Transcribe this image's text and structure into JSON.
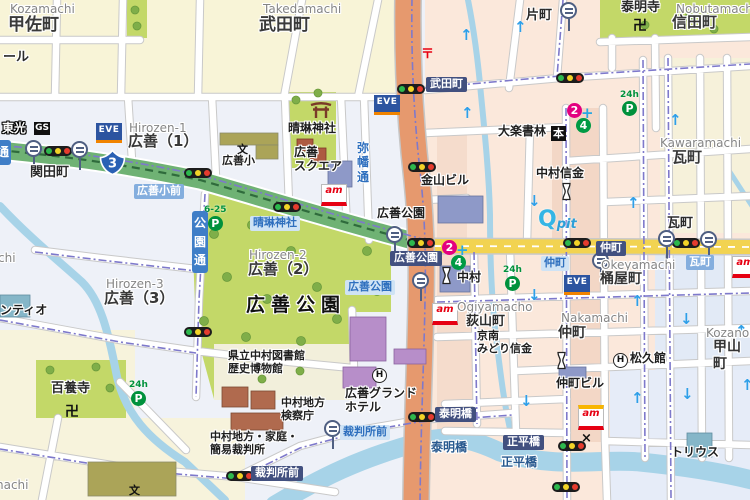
{
  "map": {
    "colors": {
      "base": "#eef1f8",
      "cream": "#f8f4d7",
      "pink": "#fbe8db",
      "pink_strip": "#f3d7c6",
      "blue_district": "#e2eaf6",
      "park_green": "#c3d868",
      "road_green": "#6fb274",
      "road_orange": "#e6996e",
      "road_yellow": "#f2d351",
      "river": "#a7d3e8",
      "label_navy": "#42507f",
      "bus_label_blue": "#2e6fbe",
      "busroute_purple": "#7e79cb"
    },
    "glyphs": {
      "eve": "EVE",
      "ampm": "am",
      "qpit_q": "Q",
      "qpit_pit": "pit",
      "gs": "GS",
      "bookstore": "本",
      "school": "文",
      "temple": "卍",
      "post_office": "〒",
      "police": "×",
      "hotel": "H",
      "route_number": "3",
      "clinic_2": "2",
      "clinic_4": "4",
      "clinic_cross": "+",
      "arrow_up": "↑",
      "arrow_down": "↓"
    },
    "labels": [
      {
        "n": "district-romaji",
        "t": "Kozamachi",
        "x": 10,
        "y": 2,
        "c": "en"
      },
      {
        "n": "district-name",
        "t": "甲佐町",
        "x": 8,
        "y": 15,
        "c": "ja17"
      },
      {
        "n": "district-romaji",
        "t": "Takedamachi",
        "x": 263,
        "y": 2,
        "c": "en"
      },
      {
        "n": "district-name",
        "t": "武田町",
        "x": 259,
        "y": 15,
        "c": "ja17"
      },
      {
        "n": "district-romaji",
        "t": "Nobutamachi",
        "x": 676,
        "y": 2,
        "c": "en"
      },
      {
        "n": "district-name",
        "t": "信田町",
        "x": 672,
        "y": 14,
        "c": "ja15"
      },
      {
        "n": "poi-label",
        "t": "泰明寺",
        "x": 621,
        "y": 0,
        "c": "ja13"
      },
      {
        "n": "district-romaji",
        "t": "Hirozen-1",
        "x": 129,
        "y": 121,
        "c": "en"
      },
      {
        "n": "district-name",
        "t": "広善（1）",
        "x": 128,
        "y": 133,
        "c": "ja15"
      },
      {
        "n": "district-romaji",
        "t": "Hirozen-2",
        "x": 249,
        "y": 248,
        "c": "en"
      },
      {
        "n": "district-name",
        "t": "広善（2）",
        "x": 248,
        "y": 261,
        "c": "ja15"
      },
      {
        "n": "district-romaji",
        "t": "Hirozen-3",
        "x": 106,
        "y": 277,
        "c": "en"
      },
      {
        "n": "district-name",
        "t": "広善（3）",
        "x": 104,
        "y": 290,
        "c": "ja15"
      },
      {
        "n": "district-romaji",
        "t": "Kawaramachi",
        "x": 660,
        "y": 136,
        "c": "en"
      },
      {
        "n": "district-name",
        "t": "瓦町",
        "x": 672,
        "y": 149,
        "c": "ja15"
      },
      {
        "n": "district-romaji",
        "t": "Okeyamachi",
        "x": 601,
        "y": 258,
        "c": "en"
      },
      {
        "n": "district-name",
        "t": "桶屋町",
        "x": 600,
        "y": 271,
        "c": "ja14"
      },
      {
        "n": "district-romaji",
        "t": "Ogiyamacho",
        "x": 457,
        "y": 300,
        "c": "en"
      },
      {
        "n": "district-name",
        "t": "荻山町",
        "x": 466,
        "y": 314,
        "c": "ja13"
      },
      {
        "n": "district-romaji",
        "t": "Nakamachi",
        "x": 561,
        "y": 311,
        "c": "en"
      },
      {
        "n": "district-name",
        "t": "仲町",
        "x": 558,
        "y": 325,
        "c": "ja14"
      },
      {
        "n": "district-romaji",
        "t": "Kozanomachi",
        "x": 706,
        "y": 326,
        "c": "en"
      },
      {
        "n": "district-name",
        "t": "甲山町",
        "x": 713,
        "y": 339,
        "c": "ja14"
      },
      {
        "n": "park-name",
        "t": "広善公園",
        "x": 246,
        "y": 294,
        "c": "park-big"
      },
      {
        "n": "area-label",
        "t": "広善公園",
        "x": 377,
        "y": 206,
        "c": "ja12"
      },
      {
        "n": "poi-label",
        "t": "百養寺",
        "x": 51,
        "y": 381,
        "c": "ja13"
      },
      {
        "n": "area-label",
        "t": "片町",
        "x": 526,
        "y": 8,
        "c": "ja13"
      },
      {
        "n": "area-label",
        "t": "瓦町",
        "x": 667,
        "y": 216,
        "c": "ja13"
      },
      {
        "n": "intersection-label",
        "t": "関田町",
        "x": 30,
        "y": 165,
        "c": "ja13"
      },
      {
        "n": "partial-label",
        "t": "ール",
        "x": 3,
        "y": 50,
        "c": "ja13"
      },
      {
        "n": "partial-label",
        "t": "chi",
        "x": -2,
        "y": 251,
        "c": "en"
      },
      {
        "n": "partial-label",
        "t": "nachi",
        "x": -4,
        "y": 478,
        "c": "en"
      },
      {
        "n": "poi-label",
        "t": "ンティオ",
        "x": 0,
        "y": 303,
        "c": "ja12"
      },
      {
        "n": "poi-label",
        "t": "晴琳神社",
        "x": 288,
        "y": 121,
        "c": "ja12"
      },
      {
        "n": "poi-label",
        "t": "広善\nスクエア",
        "x": 294,
        "y": 145,
        "c": "ja12"
      },
      {
        "n": "poi-label",
        "t": "金山ビル",
        "x": 421,
        "y": 173,
        "c": "ja12"
      },
      {
        "n": "poi-label",
        "t": "大楽書林",
        "x": 498,
        "y": 124,
        "c": "ja12"
      },
      {
        "n": "poi-label",
        "t": "中村信金",
        "x": 536,
        "y": 166,
        "c": "ja12"
      },
      {
        "n": "poi-label",
        "t": "中村",
        "x": 457,
        "y": 270,
        "c": "ja12"
      },
      {
        "n": "poi-label",
        "t": "京南\nみどり信金",
        "x": 477,
        "y": 330,
        "c": "ja11"
      },
      {
        "n": "poi-label",
        "t": "松久館",
        "x": 630,
        "y": 351,
        "c": "ja12"
      },
      {
        "n": "poi-label",
        "t": "仲町ビル",
        "x": 556,
        "y": 376,
        "c": "ja12"
      },
      {
        "n": "poi-label",
        "t": "トリウス",
        "x": 671,
        "y": 445,
        "c": "ja12"
      },
      {
        "n": "poi-label",
        "t": "県立中村図書館\n歴史博物館",
        "x": 228,
        "y": 350,
        "c": "ja11"
      },
      {
        "n": "poi-label",
        "t": "中村地方\n検察庁",
        "x": 281,
        "y": 397,
        "c": "ja11"
      },
      {
        "n": "poi-label",
        "t": "中村地方・家庭・\n簡易裁判所",
        "x": 210,
        "y": 431,
        "c": "ja11"
      },
      {
        "n": "poi-label",
        "t": "広善グランド\nホテル",
        "x": 345,
        "y": 386,
        "c": "ja12"
      },
      {
        "n": "poi-label",
        "t": "広善小",
        "x": 222,
        "y": 155,
        "c": "ja11"
      },
      {
        "n": "poi-label",
        "t": "東光",
        "x": 2,
        "y": 121,
        "c": "outline"
      },
      {
        "n": "bridge-name",
        "t": "泰明橋",
        "x": 431,
        "y": 440,
        "c": "bridge"
      },
      {
        "n": "bridge-name",
        "t": "正平橋",
        "x": 501,
        "y": 455,
        "c": "bridge"
      }
    ],
    "intersection_boxes": [
      {
        "t": "武田町",
        "x": 426,
        "y": 77
      },
      {
        "t": "広善公園",
        "x": 390,
        "y": 251
      },
      {
        "t": "仲町",
        "x": 596,
        "y": 241
      },
      {
        "t": "泰明橋",
        "x": 435,
        "y": 407
      },
      {
        "t": "正平橋",
        "x": 503,
        "y": 435
      },
      {
        "t": "裁判所前",
        "x": 251,
        "y": 466
      }
    ],
    "bus_stop_labels_pale": [
      {
        "t": "晴琳神社",
        "x": 250,
        "y": 216
      },
      {
        "t": "広善公園",
        "x": 345,
        "y": 280
      },
      {
        "t": "仲町",
        "x": 541,
        "y": 256
      },
      {
        "t": "裁判所前",
        "x": 340,
        "y": 425
      }
    ],
    "bus_stop_labels_mid": [
      {
        "t": "広善小前",
        "x": 134,
        "y": 184
      },
      {
        "t": "瓦町",
        "x": 686,
        "y": 255
      }
    ],
    "street_names": [
      {
        "t": "公\n園\n通",
        "x": 192,
        "y": 211,
        "style": "capsule"
      },
      {
        "t": "通",
        "x": -5,
        "y": 140,
        "style": "capsule"
      },
      {
        "t": "弥\n幡\n通",
        "x": 356,
        "y": 141,
        "style": "blue-text"
      }
    ],
    "route_shield": {
      "number": "3",
      "x": 99,
      "y": 149
    },
    "icons": {
      "traffic_lights": [
        [
          44,
          146
        ],
        [
          184,
          168
        ],
        [
          273,
          202
        ],
        [
          397,
          84
        ],
        [
          556,
          73
        ],
        [
          408,
          162
        ],
        [
          407,
          238
        ],
        [
          563,
          238
        ],
        [
          672,
          238
        ],
        [
          184,
          327
        ],
        [
          408,
          412
        ],
        [
          226,
          471
        ],
        [
          558,
          441
        ],
        [
          552,
          482
        ]
      ],
      "bus_stops": [
        [
          25,
          140
        ],
        [
          71,
          141
        ],
        [
          560,
          2
        ],
        [
          386,
          226
        ],
        [
          412,
          272
        ],
        [
          592,
          252
        ],
        [
          658,
          230
        ],
        [
          700,
          231
        ],
        [
          324,
          420
        ]
      ],
      "eve_logos": [
        [
          96,
          123
        ],
        [
          374,
          95
        ],
        [
          564,
          275
        ]
      ],
      "ampm_logos": [
        [
          321,
          184,
          false
        ],
        [
          432,
          303,
          false
        ],
        [
          578,
          405,
          true
        ],
        [
          732,
          256,
          false
        ]
      ],
      "qpit_logo": [
        538,
        209
      ],
      "post_office": [
        421,
        43
      ],
      "temples": [
        [
          633,
          15
        ],
        [
          65,
          401
        ]
      ],
      "schools": [
        [
          237,
          141
        ],
        [
          129,
          482
        ]
      ],
      "hotels": [
        [
          613,
          353
        ],
        [
          372,
          368
        ]
      ],
      "banks": [
        [
          440,
          266
        ],
        [
          560,
          182
        ],
        [
          555,
          351
        ]
      ],
      "police": [
        581,
        431
      ],
      "gas_station": [
        34,
        122
      ],
      "bookstore": [
        551,
        126
      ],
      "torii": [
        309,
        100
      ],
      "parkings": [
        {
          "t": "24h",
          "x": 620,
          "y": 91
        },
        {
          "t": "24h",
          "x": 129,
          "y": 381
        },
        {
          "t": "24h",
          "x": 503,
          "y": 266
        },
        {
          "t": "6-25",
          "x": 204,
          "y": 206
        }
      ],
      "clinics": [
        [
          567,
          103
        ],
        [
          442,
          208
        ]
      ],
      "oneway_arrows": [
        [
          460,
          28,
          "u"
        ],
        [
          461,
          106,
          "u"
        ],
        [
          514,
          20,
          "u"
        ],
        [
          669,
          113,
          "u"
        ],
        [
          528,
          194,
          "d"
        ],
        [
          627,
          196,
          "u"
        ],
        [
          528,
          288,
          "d"
        ],
        [
          631,
          294,
          "u"
        ],
        [
          680,
          312,
          "d"
        ],
        [
          735,
          324,
          "u"
        ],
        [
          520,
          394,
          "d"
        ],
        [
          631,
          391,
          "u"
        ],
        [
          681,
          387,
          "d"
        ],
        [
          741,
          378,
          "u"
        ]
      ]
    }
  }
}
